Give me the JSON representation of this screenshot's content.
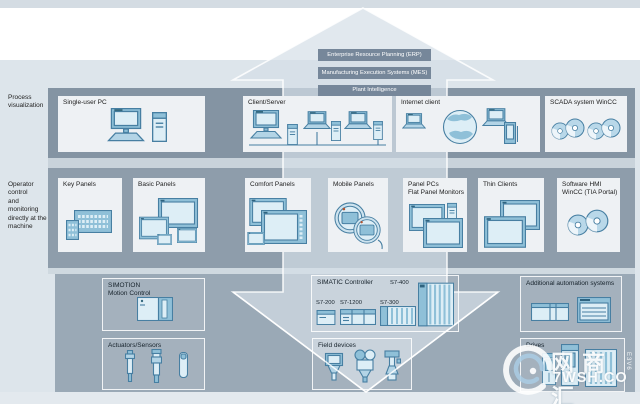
{
  "colors": {
    "page_bg": "#ffffff",
    "top_strip": "#d4dce3",
    "band_upper": "#dde5eb",
    "section_process": "#8494a3",
    "section_operator": "#8e9dab",
    "section_bottom": "#9aa9b6",
    "box_light": "#eef1f4",
    "bar_bg": "#76879a",
    "bar_text": "#ffffff",
    "label_text": "#1c1c1c",
    "icon_line": "#477fa2",
    "icon_fill": "#b3d4e6",
    "icon_light": "#ddeef6",
    "icon_mid": "#8fc0d8",
    "arrow_fill": "rgba(212,222,231,0.7)",
    "arrow_line": "rgba(255,255,255,0.85)"
  },
  "top_bars": [
    "Enterprise Resource Planning (ERP)",
    "Manufacturing Execution Systems (MES)",
    "Plant Intelligence"
  ],
  "side_labels": {
    "process": "Process\nvisualization",
    "operator": "Operator control\nand monitoring\ndirectly at the\nmachine"
  },
  "process_row": {
    "boxes": [
      {
        "label": "Single-user PC"
      },
      {
        "label": "Client/Server"
      },
      {
        "label": "Internet client"
      },
      {
        "label": "SCADA system WinCC"
      }
    ]
  },
  "operator_row": {
    "boxes": [
      {
        "label": "Key Panels"
      },
      {
        "label": "Basic Panels"
      },
      {
        "label": "Comfort Panels"
      },
      {
        "label": "Mobile Panels"
      },
      {
        "label": "Panel PCs\nFlat Panel Monitors"
      },
      {
        "label": "Thin Clients"
      },
      {
        "label": "Software HMI\nWinCC (TIA Portal)"
      }
    ]
  },
  "bottom_row": {
    "simotion": {
      "label": "SIMOTION\nMotion Control"
    },
    "simatic": {
      "title": "SIMATIC Controller",
      "models": [
        "S7-200",
        "S7-1200",
        "S7-300",
        "S7-400"
      ]
    },
    "additional": {
      "label": "Additional automation systems"
    },
    "actuators": {
      "label": "Actuators/Sensors"
    },
    "field_devices": {
      "label": "Field devices"
    },
    "drives": {
      "label": "Drives"
    }
  },
  "watermark": {
    "logo": "swirl-logo",
    "cn_text": "网商汇",
    "url_text": "7WSH.CO",
    "side_text": "E3V6"
  }
}
